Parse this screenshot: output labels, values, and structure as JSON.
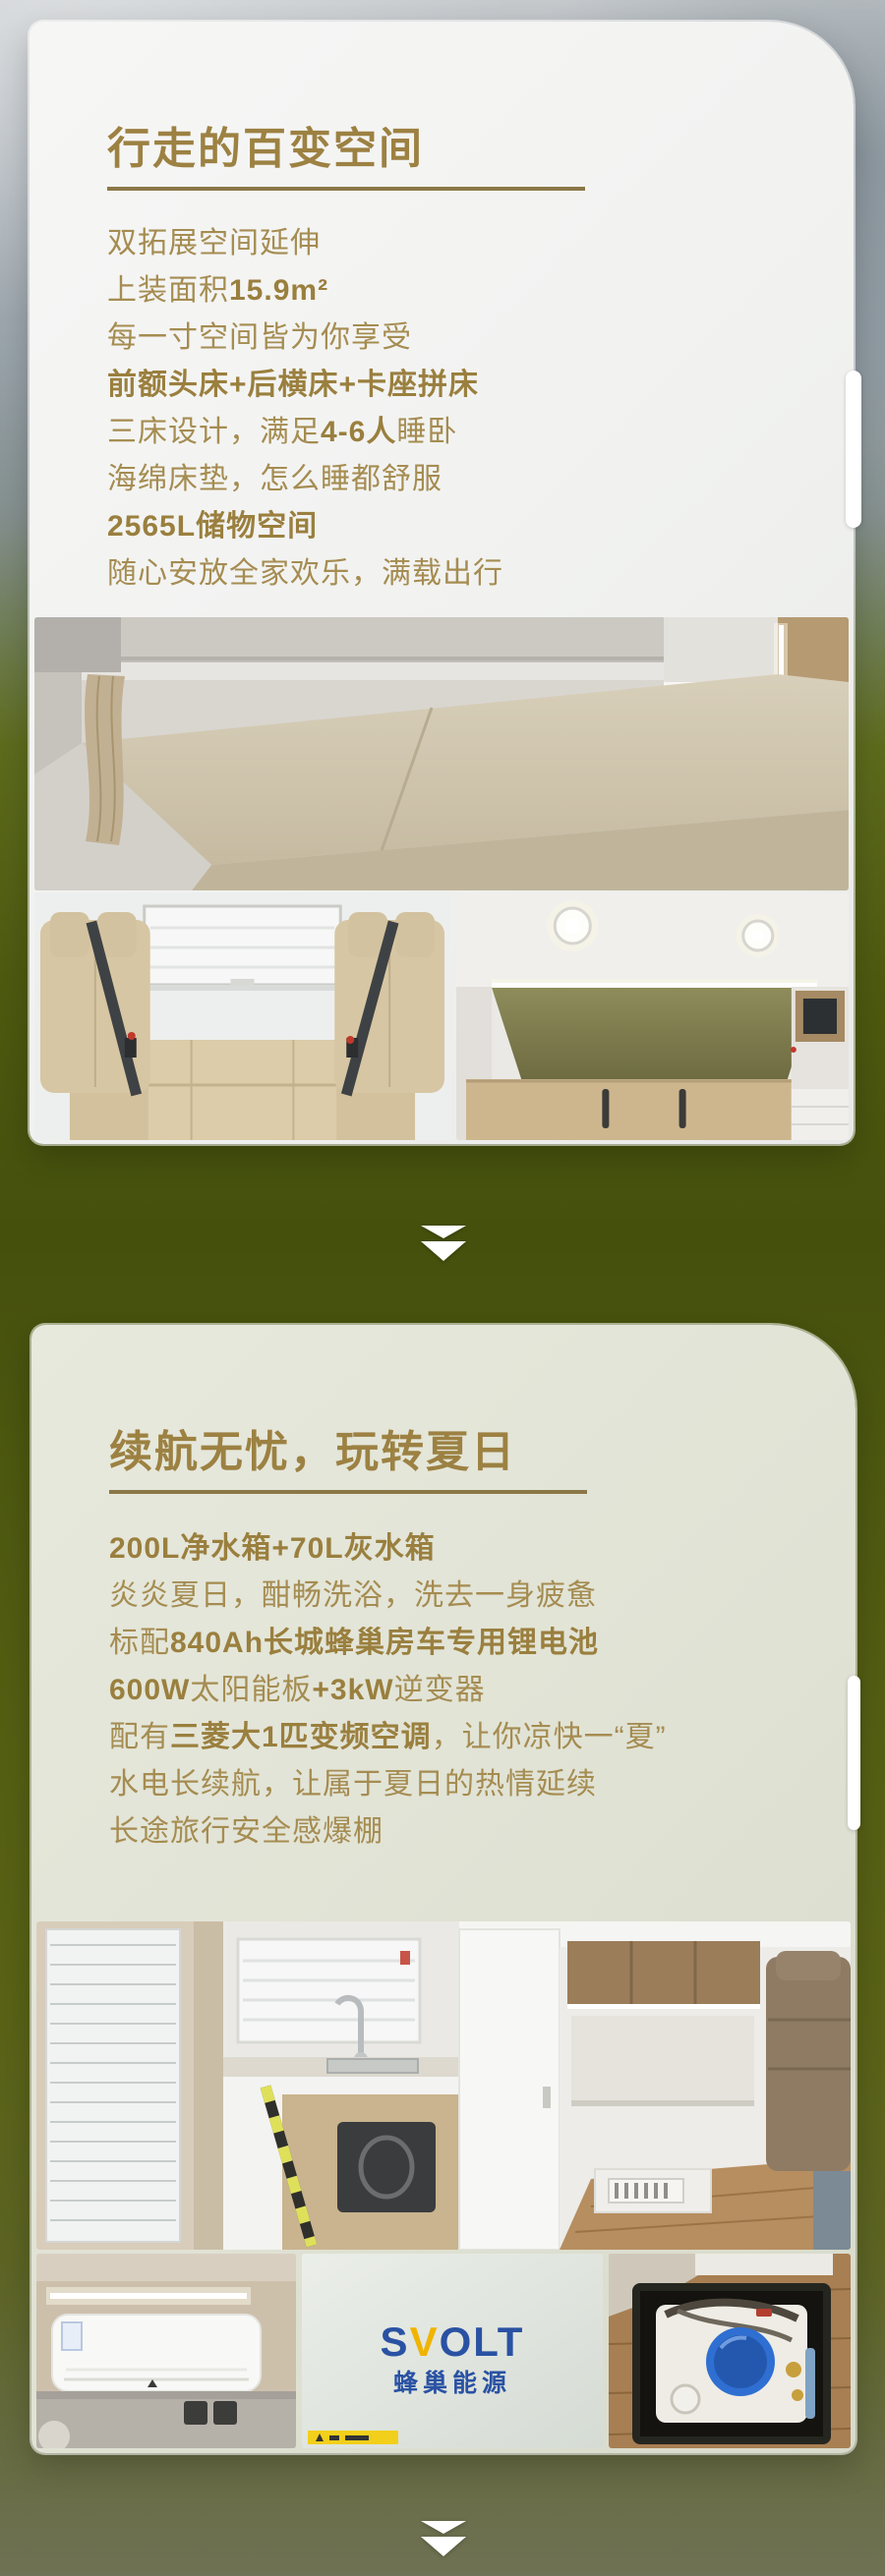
{
  "cards": [
    {
      "title": "行走的百变空间",
      "lines": [
        [
          {
            "t": "双拓展空间延伸",
            "b": false
          }
        ],
        [
          {
            "t": "上装面积",
            "b": false
          },
          {
            "t": "15.9m²",
            "b": true
          }
        ],
        [
          {
            "t": "每一寸空间皆为你享受",
            "b": false
          }
        ],
        [
          {
            "t": "前额头床+后横床+卡座拼床",
            "b": true
          }
        ],
        [
          {
            "t": "三床设计，满足",
            "b": false
          },
          {
            "t": "4-6人",
            "b": true
          },
          {
            "t": "睡卧",
            "b": false
          }
        ],
        [
          {
            "t": "海绵床垫，怎么睡都舒服",
            "b": false
          }
        ],
        [
          {
            "t": "2565L储物空间",
            "b": true
          }
        ],
        [
          {
            "t": "随心安放全家欢乐，满载出行",
            "b": false
          }
        ]
      ],
      "photos": [
        "bed-photo",
        "dinette-seats-photo",
        "garage-storage-photo"
      ]
    },
    {
      "title": "续航无忧，玩转夏日",
      "lines": [
        [
          {
            "t": "200L净水箱+70L灰水箱",
            "b": true
          }
        ],
        [
          {
            "t": "炎炎夏日，酣畅洗浴，洗去一身疲惫",
            "b": false
          }
        ],
        [
          {
            "t": "标配",
            "b": false
          },
          {
            "t": "840Ah长城蜂巢房车专用锂电池",
            "b": true
          }
        ],
        [
          {
            "t": "600W",
            "b": true
          },
          {
            "t": "太阳能板",
            "b": false
          },
          {
            "t": "+3kW",
            "b": true
          },
          {
            "t": "逆变器",
            "b": false
          }
        ],
        [
          {
            "t": "配有",
            "b": false
          },
          {
            "t": "三菱大1匹变频空调",
            "b": true
          },
          {
            "t": "，让你凉快一“夏”",
            "b": false
          }
        ],
        [
          {
            "t": "水电长续航，让属于夏日的热情延续",
            "b": false
          }
        ],
        [
          {
            "t": "长途旅行安全感爆棚",
            "b": false
          }
        ]
      ],
      "photos": [
        "kitchen-photo",
        "air-conditioner-photo",
        "svolt-battery-photo",
        "water-tank-photo"
      ],
      "svolt_logo": {
        "en_parts": [
          "S",
          "V",
          "OLT"
        ],
        "cn": "蜂巢能源"
      }
    }
  ],
  "icons": {
    "down_arrow": "double-triangle-down-icon",
    "side_tab": "scroll-thumb"
  },
  "colors": {
    "title_gold": "#9c8142",
    "body_gold": "#a58c51",
    "rule_gold": "#8b7747",
    "card1_bg": "#f1f2f0",
    "card2_bg": "#e0e2d4",
    "bg_top_gray": "#c6cacd",
    "bg_olive": "#45500d",
    "bg_bottom": "#6f7254",
    "arrow_white": "#ffffff",
    "svolt_blue": "#2a52a3",
    "svolt_yellow": "#f0b400"
  }
}
